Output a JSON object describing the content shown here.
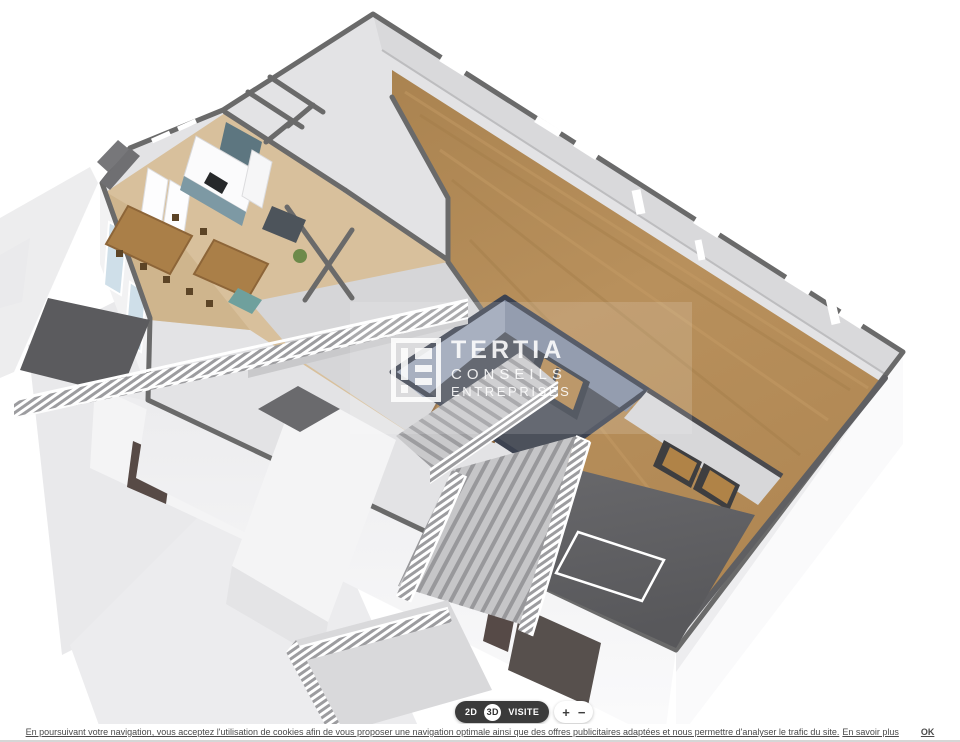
{
  "watermark": {
    "brand": "TERTIA",
    "line1": "CONSEILS",
    "line2": "ENTREPRISES"
  },
  "toolbar": {
    "mode_2d": "2D",
    "mode_3d": "3D",
    "visite": "VISITE",
    "zoom_in": "+",
    "zoom_out": "−",
    "active_mode": "3D"
  },
  "cookie_bar": {
    "message": "En poursuivant votre navigation, vous acceptez l'utilisation de cookies afin de vous proposer une navigation optimale ainsi que des offres publicitaires adaptées et nous permettre d'analyser le trafic du site.",
    "more_link": "En savoir plus",
    "ok": "OK"
  },
  "colors": {
    "wood_floor": "#b38a55",
    "room_floor_tan": "#d8c09c",
    "wall_top_line": "#6a6a6a",
    "terrace_floor": "#616164",
    "stairwell_wall": "#9aa3b6",
    "stairwell_rim": "#3c4250",
    "kitchen_teal": "#7d99a4",
    "toolbar_dark": "#3b3b3b",
    "background": "#ffffff"
  }
}
